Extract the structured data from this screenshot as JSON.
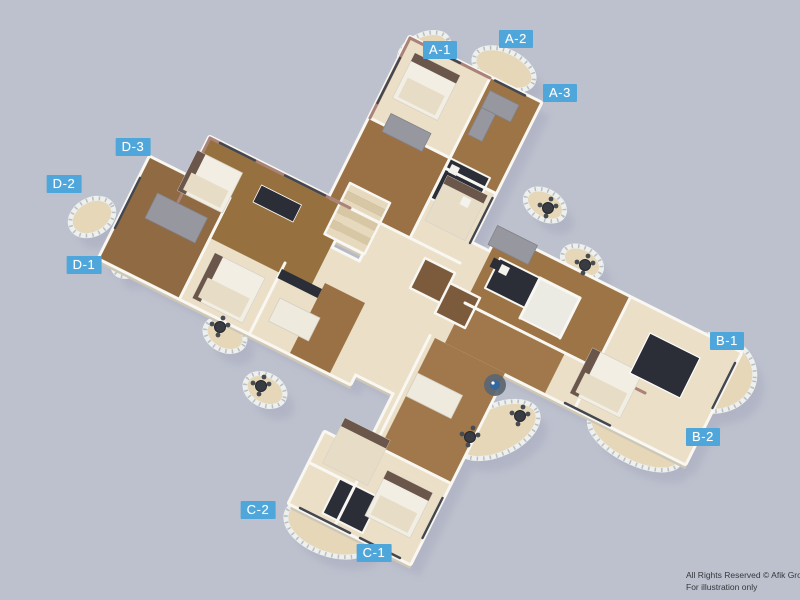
{
  "page": {
    "background": "#bdc1ce",
    "title": "3D floor plan illustration"
  },
  "unit_labels": [
    {
      "id": "a1",
      "text": "A-1",
      "x": 440,
      "y": 50
    },
    {
      "id": "a2",
      "text": "A-2",
      "x": 516,
      "y": 39
    },
    {
      "id": "a3",
      "text": "A-3",
      "x": 560,
      "y": 93
    },
    {
      "id": "b1",
      "text": "B-1",
      "x": 727,
      "y": 341
    },
    {
      "id": "b2",
      "text": "B-2",
      "x": 703,
      "y": 437
    },
    {
      "id": "c1",
      "text": "C-1",
      "x": 374,
      "y": 553
    },
    {
      "id": "c2",
      "text": "C-2",
      "x": 258,
      "y": 510
    },
    {
      "id": "d1",
      "text": "D-1",
      "x": 84,
      "y": 265
    },
    {
      "id": "d2",
      "text": "D-2",
      "x": 64,
      "y": 184
    },
    {
      "id": "d3",
      "text": "D-3",
      "x": 133,
      "y": 147
    }
  ],
  "footer": {
    "line1": "All Rights Reserved © Afik Group",
    "line2": "For illustration only"
  },
  "colors": {
    "background": "#bdc1ce",
    "label_bg": "#4fa6da",
    "label_text": "#ffffff",
    "shadow": "#a5a9bc",
    "slab_side": "#cfc7b6",
    "wall_white": "#f9f7f2",
    "carpet": "#ebdfc7",
    "balcony_floor": "#e6d7b8",
    "railing": "#eef0ee",
    "railing_posts": "#b9bfc4",
    "wood_a": "#9a7045",
    "wood_b": "#9d7446",
    "wood_c": "#a1784c",
    "wood_d": "#8f6a42",
    "wood_d3": "#96713f",
    "elevator_floor": "#7c5b3d",
    "bath": "#ecebe3",
    "dark_furniture": "#2b2e36",
    "gray_sofa": "#97989f",
    "white_furniture": "#f2eee3",
    "tan_bed": "#e7ddc7",
    "headboard": "#6b564b",
    "mauve_wall": "#ab8278",
    "window_frame": "#43474f",
    "stair_light": "#e6d9bd",
    "stair_dark": "#d7c7a5",
    "rug": "#5c6670",
    "table_blue": "#35679f"
  }
}
